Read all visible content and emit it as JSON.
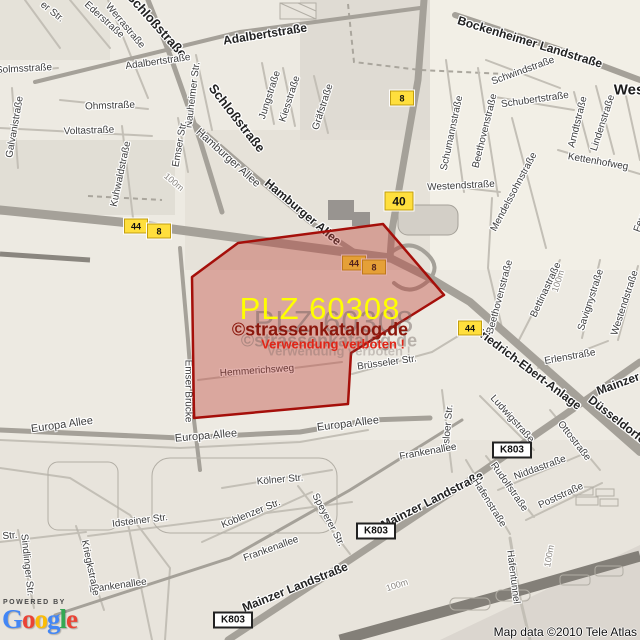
{
  "colors": {
    "badge_yellow": "#ffdf3d",
    "polygon_fill": "rgba(186,58,48,0.38)",
    "polygon_border": "#a50f0a",
    "plz_color": "#ffff00",
    "site_color": "#8b170c",
    "warn_color": "#e02517"
  },
  "watermark": {
    "plz": "PLZ 60308",
    "site": "©strassenkatalog.de",
    "warning": "Verwendung verboten !"
  },
  "attribution": {
    "powered_by": "POWERED BY",
    "map_data": "Map data ©2010 Tele Atlas",
    "google_letters": [
      {
        "ch": "G",
        "color": "#4286f5"
      },
      {
        "ch": "o",
        "color": "#ea4335"
      },
      {
        "ch": "o",
        "color": "#fbbc05"
      },
      {
        "ch": "g",
        "color": "#4286f5"
      },
      {
        "ch": "l",
        "color": "#34a853"
      },
      {
        "ch": "e",
        "color": "#ea4335"
      }
    ]
  },
  "badges": {
    "under_overlay": [
      {
        "t": "44",
        "x": 354,
        "y": 263,
        "type": "motorway"
      },
      {
        "t": "8",
        "x": 374,
        "y": 267,
        "type": "motorway"
      }
    ],
    "over_overlay": [
      {
        "t": "44",
        "x": 136,
        "y": 226,
        "type": "motorway"
      },
      {
        "t": "8",
        "x": 159,
        "y": 231,
        "type": "motorway"
      },
      {
        "t": "8",
        "x": 402,
        "y": 98,
        "type": "motorway"
      },
      {
        "t": "40",
        "x": 399,
        "y": 201,
        "type": "motorway-lg"
      },
      {
        "t": "44",
        "x": 470,
        "y": 328,
        "type": "motorway"
      },
      {
        "t": "K803",
        "x": 512,
        "y": 450,
        "type": "k"
      },
      {
        "t": "K803",
        "x": 376,
        "y": 531,
        "type": "k"
      },
      {
        "t": "K803",
        "x": 233,
        "y": 620,
        "type": "k"
      }
    ]
  },
  "labels": [
    {
      "t": "er Str.",
      "x": 52,
      "y": 12,
      "r": 38,
      "s": 10
    },
    {
      "t": "Ederstraße",
      "x": 104,
      "y": 20,
      "r": 42,
      "s": 10
    },
    {
      "t": "Werrastraße",
      "x": 125,
      "y": 26,
      "r": 50,
      "s": 10
    },
    {
      "t": "Schloßstraße",
      "x": 157,
      "y": 25,
      "r": 48,
      "s": 13,
      "b": 1
    },
    {
      "t": "Adalbertstraße",
      "x": 158,
      "y": 62,
      "r": -8,
      "s": 10
    },
    {
      "t": "Adalbertstraße",
      "x": 265,
      "y": 34,
      "r": -9,
      "s": 12,
      "b": 1
    },
    {
      "t": "Bockenheimer Landstraße",
      "x": 530,
      "y": 42,
      "r": 17,
      "s": 12,
      "b": 1
    },
    {
      "t": "Schwindstraße",
      "x": 523,
      "y": 71,
      "r": -20,
      "s": 10
    },
    {
      "t": "Schubertstraße",
      "x": 535,
      "y": 100,
      "r": -8,
      "s": 10
    },
    {
      "t": "Jungstraße",
      "x": 270,
      "y": 95,
      "r": -72,
      "s": 10
    },
    {
      "t": "Kiesstraße",
      "x": 290,
      "y": 99,
      "r": -72,
      "s": 10
    },
    {
      "t": "Gräfstraße",
      "x": 323,
      "y": 107,
      "r": -72,
      "s": 10
    },
    {
      "t": "Schloßstraße",
      "x": 237,
      "y": 118,
      "r": 52,
      "s": 13,
      "b": 1
    },
    {
      "t": "Solmsstraße",
      "x": 24,
      "y": 69,
      "r": -3,
      "s": 10
    },
    {
      "t": "Ohmstraße",
      "x": 110,
      "y": 106,
      "r": -2,
      "s": 10
    },
    {
      "t": "Voltastraße",
      "x": 89,
      "y": 131,
      "r": -2,
      "s": 10
    },
    {
      "t": "Galvanistraße",
      "x": 15,
      "y": 127,
      "r": -80,
      "s": 10
    },
    {
      "t": "Kuhwaldstraße",
      "x": 121,
      "y": 174,
      "r": -78,
      "s": 10
    },
    {
      "t": "Nauheimer Str.",
      "x": 193,
      "y": 95,
      "r": -83,
      "s": 10
    },
    {
      "t": "Emser Str.",
      "x": 180,
      "y": 144,
      "r": -80,
      "s": 10
    },
    {
      "t": "Hamburger Allee",
      "x": 228,
      "y": 158,
      "r": 42,
      "s": 11
    },
    {
      "t": "Hamburger Allee",
      "x": 303,
      "y": 212,
      "r": 40,
      "s": 12,
      "b": 1
    },
    {
      "t": "Schumannstraße",
      "x": 452,
      "y": 133,
      "r": -78,
      "s": 10
    },
    {
      "t": "Beethovenstraße",
      "x": 485,
      "y": 131,
      "r": -76,
      "s": 10
    },
    {
      "t": "Mendelssohnstraße",
      "x": 514,
      "y": 192,
      "r": -62,
      "s": 10
    },
    {
      "t": "Arndtstraße",
      "x": 578,
      "y": 122,
      "r": -76,
      "s": 10
    },
    {
      "t": "Lindenstraße",
      "x": 603,
      "y": 123,
      "r": -72,
      "s": 10
    },
    {
      "t": "Kettenhofweg",
      "x": 598,
      "y": 162,
      "r": 10,
      "s": 10
    },
    {
      "t": "Feuerbachstraße",
      "x": 650,
      "y": 196,
      "r": -70,
      "s": 10
    },
    {
      "t": "Wes",
      "x": 629,
      "y": 90,
      "r": 0,
      "s": 15,
      "b": 1,
      "c": "#1a1a1a"
    },
    {
      "t": "Westendstraße",
      "x": 461,
      "y": 186,
      "r": -3,
      "s": 10
    },
    {
      "t": "Westendstraße",
      "x": 625,
      "y": 303,
      "r": -72,
      "s": 10
    },
    {
      "t": "Beethovenstraße",
      "x": 500,
      "y": 297,
      "r": -75,
      "s": 10
    },
    {
      "t": "Bettinastraße",
      "x": 546,
      "y": 290,
      "r": -65,
      "s": 10
    },
    {
      "t": "Savignystraße",
      "x": 591,
      "y": 300,
      "r": -72,
      "s": 10
    },
    {
      "t": "Erlenstraße",
      "x": 570,
      "y": 357,
      "r": -10,
      "s": 10
    },
    {
      "t": "Friedrich-Ebert-Anlage",
      "x": 528,
      "y": 368,
      "r": 37,
      "s": 12,
      "b": 1
    },
    {
      "t": "Mainzer Landstraße",
      "x": 650,
      "y": 372,
      "r": -20,
      "s": 12,
      "b": 1
    },
    {
      "t": "Düsseldorfer Str.",
      "x": 628,
      "y": 428,
      "r": 38,
      "s": 12,
      "b": 1
    },
    {
      "t": "Mainzer Landstraße",
      "x": 432,
      "y": 500,
      "r": -27,
      "s": 12,
      "b": 1
    },
    {
      "t": "Mainzer Landstraße",
      "x": 295,
      "y": 587,
      "r": -22,
      "s": 12,
      "b": 1
    },
    {
      "t": "Ludwigstraße",
      "x": 512,
      "y": 419,
      "r": 48,
      "s": 10
    },
    {
      "t": "Ottostraße",
      "x": 574,
      "y": 441,
      "r": 52,
      "s": 10
    },
    {
      "t": "Niddastraße",
      "x": 540,
      "y": 468,
      "r": -20,
      "s": 10
    },
    {
      "t": "Rudolfstraße",
      "x": 509,
      "y": 487,
      "r": 55,
      "s": 10
    },
    {
      "t": "Poststraße",
      "x": 561,
      "y": 496,
      "r": -25,
      "s": 10
    },
    {
      "t": "Hafenstraße",
      "x": 489,
      "y": 503,
      "r": 58,
      "s": 10
    },
    {
      "t": "Hafentunnel",
      "x": 513,
      "y": 577,
      "r": 83,
      "s": 10
    },
    {
      "t": "Osloer Str.",
      "x": 448,
      "y": 428,
      "r": -85,
      "s": 10
    },
    {
      "t": "Frankenallee",
      "x": 428,
      "y": 452,
      "r": -10,
      "s": 10
    },
    {
      "t": "Frankenallee",
      "x": 271,
      "y": 549,
      "r": -20,
      "s": 10
    },
    {
      "t": "Frankenallee",
      "x": 118,
      "y": 586,
      "r": -8,
      "s": 10
    },
    {
      "t": "Europa Allee",
      "x": 62,
      "y": 425,
      "r": -8,
      "s": 11
    },
    {
      "t": "Europa Allee",
      "x": 206,
      "y": 436,
      "r": -5,
      "s": 11
    },
    {
      "t": "Europa Allee",
      "x": 348,
      "y": 424,
      "r": -7,
      "s": 11
    },
    {
      "t": "Emser Brücke",
      "x": 188,
      "y": 391,
      "r": 90,
      "s": 10
    },
    {
      "t": "Hemmerichsweg",
      "x": 257,
      "y": 371,
      "r": -4,
      "s": 10
    },
    {
      "t": "Brüsseler Str.",
      "x": 387,
      "y": 363,
      "r": -8,
      "s": 10
    },
    {
      "t": "Kölner Str.",
      "x": 280,
      "y": 480,
      "r": -5,
      "s": 10
    },
    {
      "t": "Koblenzer Str.",
      "x": 251,
      "y": 514,
      "r": -22,
      "s": 10
    },
    {
      "t": "Speyerer Str.",
      "x": 328,
      "y": 520,
      "r": 62,
      "s": 10
    },
    {
      "t": "Idsteiner Str.",
      "x": 140,
      "y": 521,
      "r": -7,
      "s": 10
    },
    {
      "t": "Str.",
      "x": 10,
      "y": 536,
      "r": -5,
      "s": 10
    },
    {
      "t": "Sindlinger Str.",
      "x": 27,
      "y": 565,
      "r": 84,
      "s": 10
    },
    {
      "t": "Kriegkstraße",
      "x": 90,
      "y": 568,
      "r": 78,
      "s": 10
    },
    {
      "t": "100m",
      "x": 174,
      "y": 182,
      "r": 40,
      "s": 9,
      "c": "#8a8680"
    },
    {
      "t": "100m",
      "x": 558,
      "y": 281,
      "r": -72,
      "s": 9,
      "c": "#8a8680"
    },
    {
      "t": "100m",
      "x": 397,
      "y": 585,
      "r": -18,
      "s": 9,
      "c": "#8a8680"
    },
    {
      "t": "100m",
      "x": 549,
      "y": 556,
      "r": -80,
      "s": 9,
      "c": "#8a8680"
    }
  ]
}
